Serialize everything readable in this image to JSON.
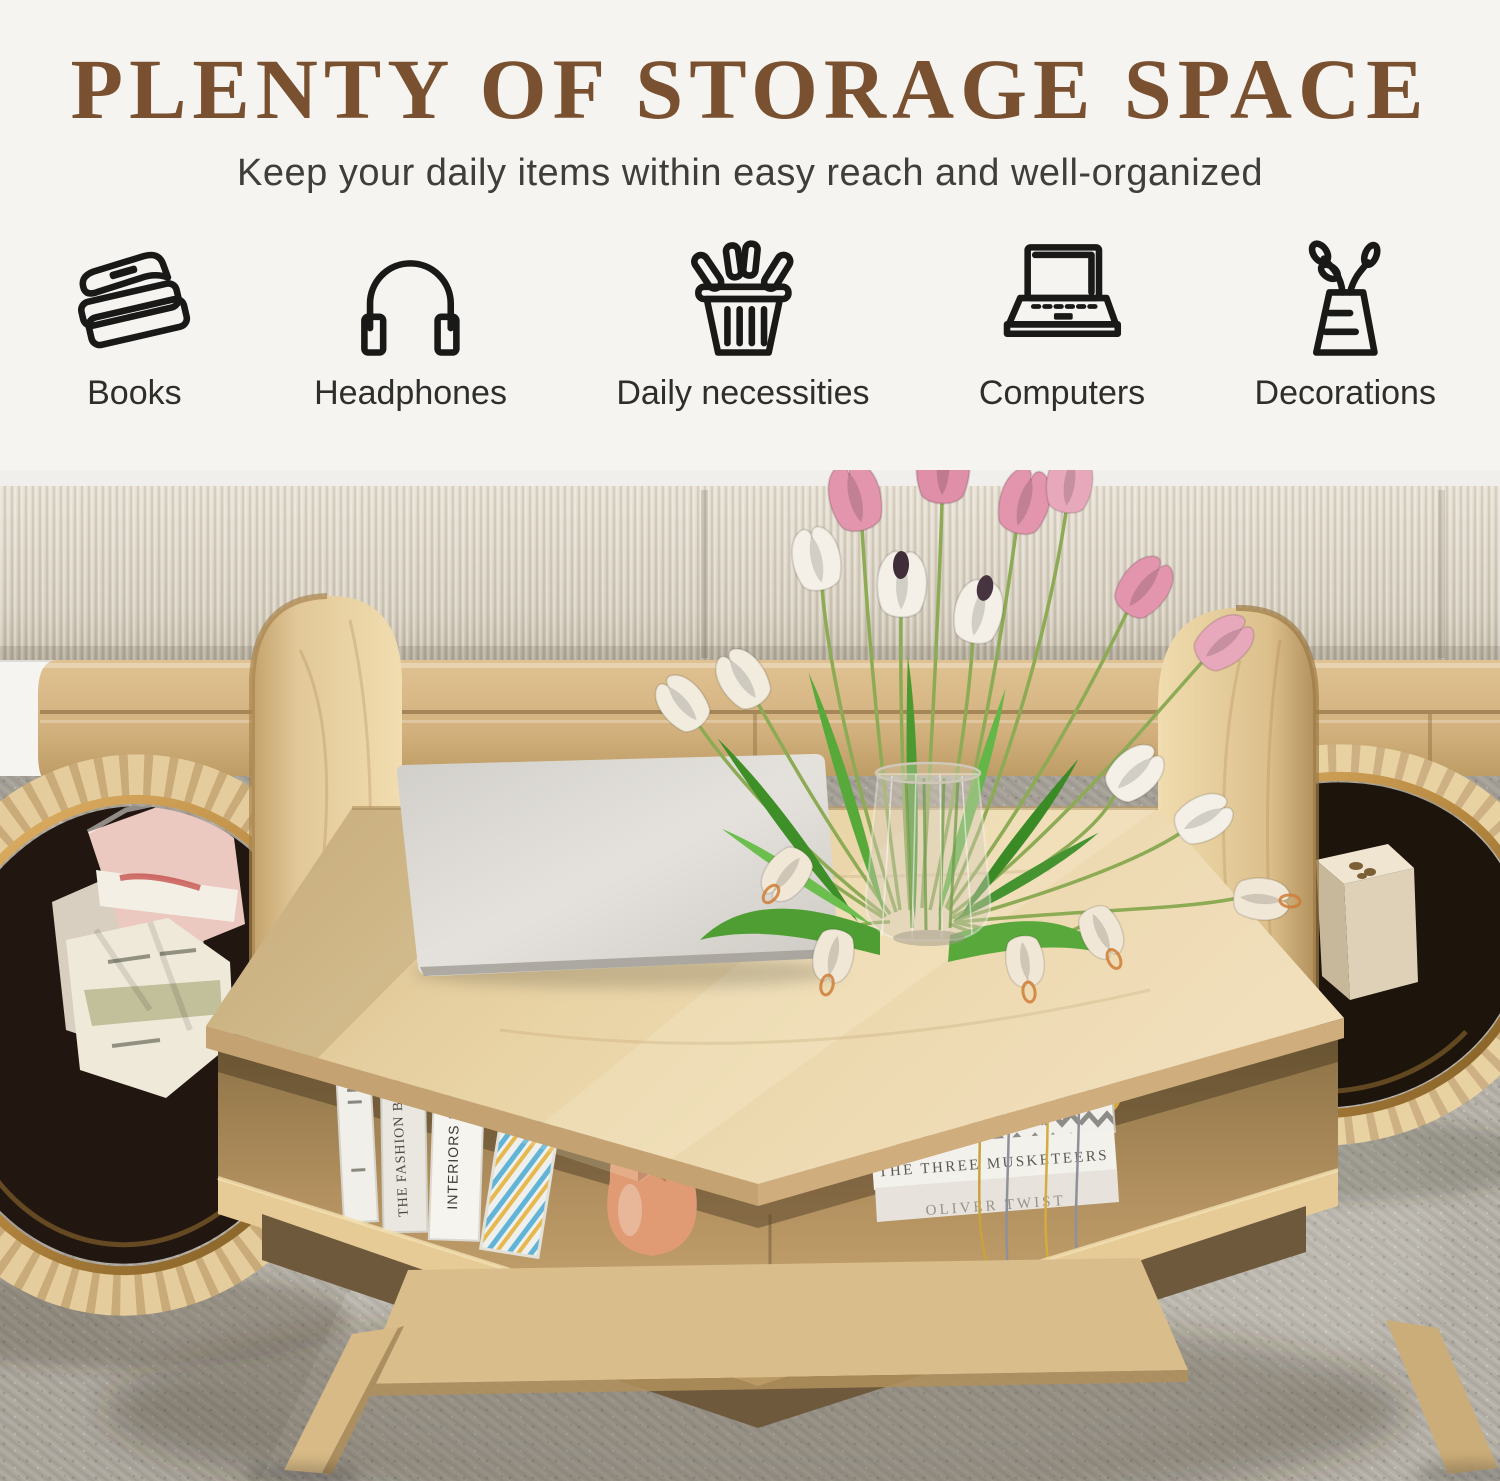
{
  "header": {
    "title": "PLENTY OF STORAGE SPACE",
    "subtitle": "Keep your daily items within easy reach and well-organized",
    "features": [
      {
        "label": "Books",
        "icon": "books-icon"
      },
      {
        "label": "Headphones",
        "icon": "headphones-icon"
      },
      {
        "label": "Daily necessities",
        "icon": "shopping-basket-icon"
      },
      {
        "label": "Computers",
        "icon": "laptop-icon"
      },
      {
        "label": "Decorations",
        "icon": "vase-plant-icon"
      }
    ]
  },
  "photo": {
    "book_spines": {
      "fashion": "THE FASHION BOOK",
      "interiors": "INTERIORS NOW",
      "musketeers": "THE THREE MUSKETEERS",
      "oliver": "OLIVER TWIST"
    },
    "colors": {
      "title_brown": "#7a5130",
      "oak_wood": "#e7d2a4",
      "brass_rim": "#b98a42",
      "bin_interior": "#20160d",
      "carpet_gray": "#b4b0a7",
      "cushion_beige": "#d8d1c2"
    }
  }
}
